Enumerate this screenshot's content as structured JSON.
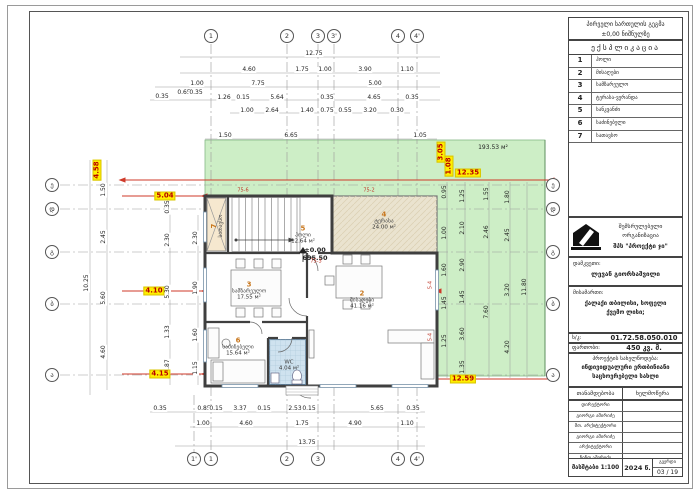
{
  "header": {
    "title_line1": "პირველი სართულის გეგმა",
    "title_line2": "±0,00 ნიშნულზე",
    "legend_title": "ექსპლიკაცია"
  },
  "legend": [
    {
      "num": "1",
      "label": "ჰოლი"
    },
    {
      "num": "2",
      "label": "მისაღები"
    },
    {
      "num": "3",
      "label": "სამზარეულო"
    },
    {
      "num": "4",
      "label": "ტერასა-ვერანდა"
    },
    {
      "num": "5",
      "label": "სანკვანძი"
    },
    {
      "num": "6",
      "label": "საძინებელი"
    },
    {
      "num": "7",
      "label": "სათავსო"
    }
  ],
  "titleblock": {
    "org_label": "შემსრულებელი ორგანიზაცია",
    "org_name": "შპს \"პროექტი ჯი\"",
    "client_label": "დამკვეთი:",
    "client_name": "ლევან გიორხაშვილი",
    "address_label": "მისამართი:",
    "address_line1": "ქალაქი თბილისი, სოფელი",
    "address_line2": "ქვემო ლისი;",
    "cadastral_label": "ს/კ:",
    "cadastral_value": "01.72.58.050.010",
    "area_label": "ფართობი:",
    "area_value": "450 კვ. მ.",
    "project_label": "პროექტის სახელწოდება:",
    "project_name_line1": "ინდივიდუალური ერთბინიანი",
    "project_name_line2": "საცხოვრებელი სახლი",
    "col_position": "თანამდებობა",
    "col_signature": "ხელმოწერა",
    "roles": [
      "დირექტორი",
      "გიორგი ამირიძე",
      "მთ. არქიტექტორი",
      "გიორგი ამირიძე",
      "არქიტექტორი",
      "ნინო ამირიძე"
    ],
    "scale": "მასშტაბი 1:100",
    "year": "2024 წ.",
    "page_label": "გვერდი",
    "page_value": "03 / 19"
  },
  "plan": {
    "lawn_area": "193.53 м²",
    "rooms": [
      {
        "num": "7",
        "name": "სათავსო",
        "area": "",
        "x": 217,
        "y": 226,
        "r": -90
      },
      {
        "num": "5",
        "name": "ჰოლი",
        "area": "12.64 м²",
        "x": 303,
        "y": 235,
        "r": 0
      },
      {
        "num": "4",
        "name": "ტერასა",
        "area": "24.00 м²",
        "x": 384,
        "y": 221,
        "r": 0
      },
      {
        "num": "3",
        "name": "სამზარეულო",
        "area": "17.55 м²",
        "x": 249,
        "y": 291,
        "r": 0
      },
      {
        "num": "6",
        "name": "საძინებელი",
        "area": "15.64 м²",
        "x": 238,
        "y": 347,
        "r": 0
      },
      {
        "num": "2",
        "name": "მისაღები",
        "area": "41.16 м²",
        "x": 362,
        "y": 300,
        "r": 0
      },
      {
        "num": "",
        "name": "WC",
        "area": "4.04 м²",
        "x": 289,
        "y": 366,
        "r": 0
      }
    ],
    "tags": [
      {
        "t": "75-6",
        "x": 243,
        "y": 191,
        "r": 0
      },
      {
        "t": "75-2",
        "x": 369,
        "y": 191,
        "r": 0
      },
      {
        "t": "75-3",
        "x": 316,
        "y": 262,
        "r": 0
      },
      {
        "t": "5-4",
        "x": 431,
        "y": 285,
        "r": -90
      },
      {
        "t": "5-4",
        "x": 431,
        "y": 337,
        "r": -90
      }
    ]
  },
  "dims": [
    {
      "t": "12.75",
      "x": 314,
      "y": 54
    },
    {
      "t": "4.60",
      "x": 249,
      "y": 70
    },
    {
      "t": "1.75",
      "x": 302,
      "y": 70
    },
    {
      "t": "1.00",
      "x": 325,
      "y": 70
    },
    {
      "t": "3.90",
      "x": 365,
      "y": 70
    },
    {
      "t": "1.10",
      "x": 407,
      "y": 70
    },
    {
      "t": "1.00",
      "x": 197,
      "y": 84
    },
    {
      "t": "7.75",
      "x": 258,
      "y": 84
    },
    {
      "t": "5.00",
      "x": 375,
      "y": 84
    },
    {
      "t": "0.35",
      "x": 162,
      "y": 97
    },
    {
      "t": "0.65",
      "x": 184,
      "y": 93
    },
    {
      "t": "0.35",
      "x": 196,
      "y": 93
    },
    {
      "t": "1.26",
      "x": 224,
      "y": 98
    },
    {
      "t": "0.15",
      "x": 243,
      "y": 98
    },
    {
      "t": "5.64",
      "x": 277,
      "y": 98
    },
    {
      "t": "0.35",
      "x": 327,
      "y": 98
    },
    {
      "t": "4.65",
      "x": 374,
      "y": 98
    },
    {
      "t": "0.35",
      "x": 412,
      "y": 98
    },
    {
      "t": "1.00",
      "x": 247,
      "y": 111
    },
    {
      "t": "2.64",
      "x": 272,
      "y": 111
    },
    {
      "t": "1.40",
      "x": 307,
      "y": 111
    },
    {
      "t": "0.75",
      "x": 327,
      "y": 111
    },
    {
      "t": "0.55",
      "x": 345,
      "y": 111
    },
    {
      "t": "3.20",
      "x": 370,
      "y": 111
    },
    {
      "t": "0.30",
      "x": 397,
      "y": 111
    },
    {
      "t": "1.50",
      "x": 225,
      "y": 136
    },
    {
      "t": "6.65",
      "x": 291,
      "y": 136
    },
    {
      "t": "1.05",
      "x": 420,
      "y": 136
    },
    {
      "t": "3.05",
      "x": 441,
      "y": 152,
      "r": -90,
      "c": "hl"
    },
    {
      "t": "1.08",
      "x": 449,
      "y": 166,
      "r": -90,
      "c": "hl"
    },
    {
      "t": "4.58",
      "x": 97,
      "y": 170,
      "r": -90,
      "c": "hl"
    },
    {
      "t": "10.25",
      "x": 87,
      "y": 283,
      "r": -90
    },
    {
      "t": "1.50",
      "x": 104,
      "y": 190,
      "r": -90
    },
    {
      "t": "2.45",
      "x": 104,
      "y": 237,
      "r": -90
    },
    {
      "t": "5.60",
      "x": 104,
      "y": 298,
      "r": -90
    },
    {
      "t": "4.60",
      "x": 104,
      "y": 352,
      "r": -90
    },
    {
      "t": "0.35",
      "x": 168,
      "y": 207,
      "r": -90
    },
    {
      "t": "2.30",
      "x": 168,
      "y": 240,
      "r": -90
    },
    {
      "t": "5.30",
      "x": 168,
      "y": 292,
      "r": -90
    },
    {
      "t": "1.33",
      "x": 168,
      "y": 332,
      "r": -90
    },
    {
      "t": "1.87",
      "x": 168,
      "y": 366,
      "r": -90
    },
    {
      "t": "2.30",
      "x": 196,
      "y": 238,
      "r": -90
    },
    {
      "t": "1.90",
      "x": 196,
      "y": 288,
      "r": -90
    },
    {
      "t": "1.60",
      "x": 196,
      "y": 335,
      "r": -90
    },
    {
      "t": "1.15",
      "x": 196,
      "y": 368,
      "r": -90
    },
    {
      "t": "5.04",
      "x": 165,
      "y": 196,
      "c": "hl"
    },
    {
      "t": "4.10",
      "x": 154,
      "y": 291,
      "c": "hl"
    },
    {
      "t": "4.15",
      "x": 160,
      "y": 374,
      "c": "hl"
    },
    {
      "t": "193.53 м²",
      "x": 493,
      "y": 148,
      "c": "grn"
    },
    {
      "t": "12.35",
      "x": 468,
      "y": 173,
      "c": "hl"
    },
    {
      "t": "12.59",
      "x": 463,
      "y": 379,
      "c": "hl"
    },
    {
      "t": "11.80",
      "x": 525,
      "y": 287,
      "r": -90,
      "c": "grn"
    },
    {
      "t": "1.80",
      "x": 508,
      "y": 197,
      "r": -90,
      "c": "grn"
    },
    {
      "t": "2.45",
      "x": 508,
      "y": 235,
      "r": -90,
      "c": "grn"
    },
    {
      "t": "3.20",
      "x": 508,
      "y": 290,
      "r": -90,
      "c": "grn"
    },
    {
      "t": "4.20",
      "x": 508,
      "y": 347,
      "r": -90,
      "c": "grn"
    },
    {
      "t": "1.55",
      "x": 487,
      "y": 194,
      "r": -90,
      "c": "grn"
    },
    {
      "t": "2.46",
      "x": 487,
      "y": 232,
      "r": -90,
      "c": "grn"
    },
    {
      "t": "7.60",
      "x": 487,
      "y": 312,
      "r": -90,
      "c": "grn"
    },
    {
      "t": "1.25",
      "x": 463,
      "y": 196,
      "r": -90,
      "c": "grn"
    },
    {
      "t": "2.10",
      "x": 463,
      "y": 228,
      "r": -90,
      "c": "grn"
    },
    {
      "t": "2.90",
      "x": 463,
      "y": 265,
      "r": -90,
      "c": "grn"
    },
    {
      "t": "1.45",
      "x": 463,
      "y": 297,
      "r": -90,
      "c": "grn"
    },
    {
      "t": "3.60",
      "x": 463,
      "y": 334,
      "r": -90,
      "c": "grn"
    },
    {
      "t": "1.35",
      "x": 463,
      "y": 367,
      "r": -90,
      "c": "grn"
    },
    {
      "t": "0.95",
      "x": 445,
      "y": 192,
      "r": -90,
      "c": "grn"
    },
    {
      "t": "1.00",
      "x": 445,
      "y": 233,
      "r": -90,
      "c": "grn"
    },
    {
      "t": "1.60",
      "x": 445,
      "y": 270,
      "r": -90,
      "c": "grn"
    },
    {
      "t": "1.45",
      "x": 445,
      "y": 303,
      "r": -90,
      "c": "grn"
    },
    {
      "t": "1.25",
      "x": 445,
      "y": 341,
      "r": -90,
      "c": "grn"
    },
    {
      "t": "0.35",
      "x": 160,
      "y": 409
    },
    {
      "t": "0.85",
      "x": 204,
      "y": 409
    },
    {
      "t": "0.15",
      "x": 216,
      "y": 409
    },
    {
      "t": "3.37",
      "x": 240,
      "y": 409
    },
    {
      "t": "0.15",
      "x": 264,
      "y": 409
    },
    {
      "t": "2.53",
      "x": 295,
      "y": 409
    },
    {
      "t": "0.15",
      "x": 309,
      "y": 409
    },
    {
      "t": "5.65",
      "x": 377,
      "y": 409
    },
    {
      "t": "0.35",
      "x": 413,
      "y": 409
    },
    {
      "t": "1.00",
      "x": 203,
      "y": 424
    },
    {
      "t": "4.60",
      "x": 246,
      "y": 424
    },
    {
      "t": "1.75",
      "x": 302,
      "y": 424
    },
    {
      "t": "4.90",
      "x": 355,
      "y": 424
    },
    {
      "t": "1.10",
      "x": 407,
      "y": 424
    },
    {
      "t": "13.75",
      "x": 307,
      "y": 443
    },
    {
      "t": "±0.00",
      "x": 315,
      "y": 250,
      "c": "elev"
    },
    {
      "t": "695.50",
      "x": 315,
      "y": 258,
      "c": "elev"
    }
  ],
  "bubbles": [
    {
      "t": "1",
      "x": 211,
      "y": 36
    },
    {
      "t": "2",
      "x": 287,
      "y": 36
    },
    {
      "t": "3",
      "x": 318,
      "y": 36
    },
    {
      "t": "3'",
      "x": 334,
      "y": 36
    },
    {
      "t": "4",
      "x": 398,
      "y": 36
    },
    {
      "t": "4'",
      "x": 417,
      "y": 36
    },
    {
      "t": "1'",
      "x": 194,
      "y": 459
    },
    {
      "t": "1",
      "x": 211,
      "y": 459
    },
    {
      "t": "2",
      "x": 287,
      "y": 459
    },
    {
      "t": "3",
      "x": 318,
      "y": 459
    },
    {
      "t": "4",
      "x": 398,
      "y": 459
    },
    {
      "t": "4'",
      "x": 417,
      "y": 459
    },
    {
      "t": "ე",
      "x": 52,
      "y": 185
    },
    {
      "t": "დ",
      "x": 52,
      "y": 209
    },
    {
      "t": "გ",
      "x": 52,
      "y": 252
    },
    {
      "t": "ბ",
      "x": 52,
      "y": 304
    },
    {
      "t": "ა",
      "x": 52,
      "y": 375
    },
    {
      "t": "ე",
      "x": 553,
      "y": 185
    },
    {
      "t": "დ",
      "x": 553,
      "y": 209
    },
    {
      "t": "გ",
      "x": 553,
      "y": 252
    },
    {
      "t": "ბ",
      "x": 553,
      "y": 304
    },
    {
      "t": "ა",
      "x": 553,
      "y": 375
    }
  ]
}
